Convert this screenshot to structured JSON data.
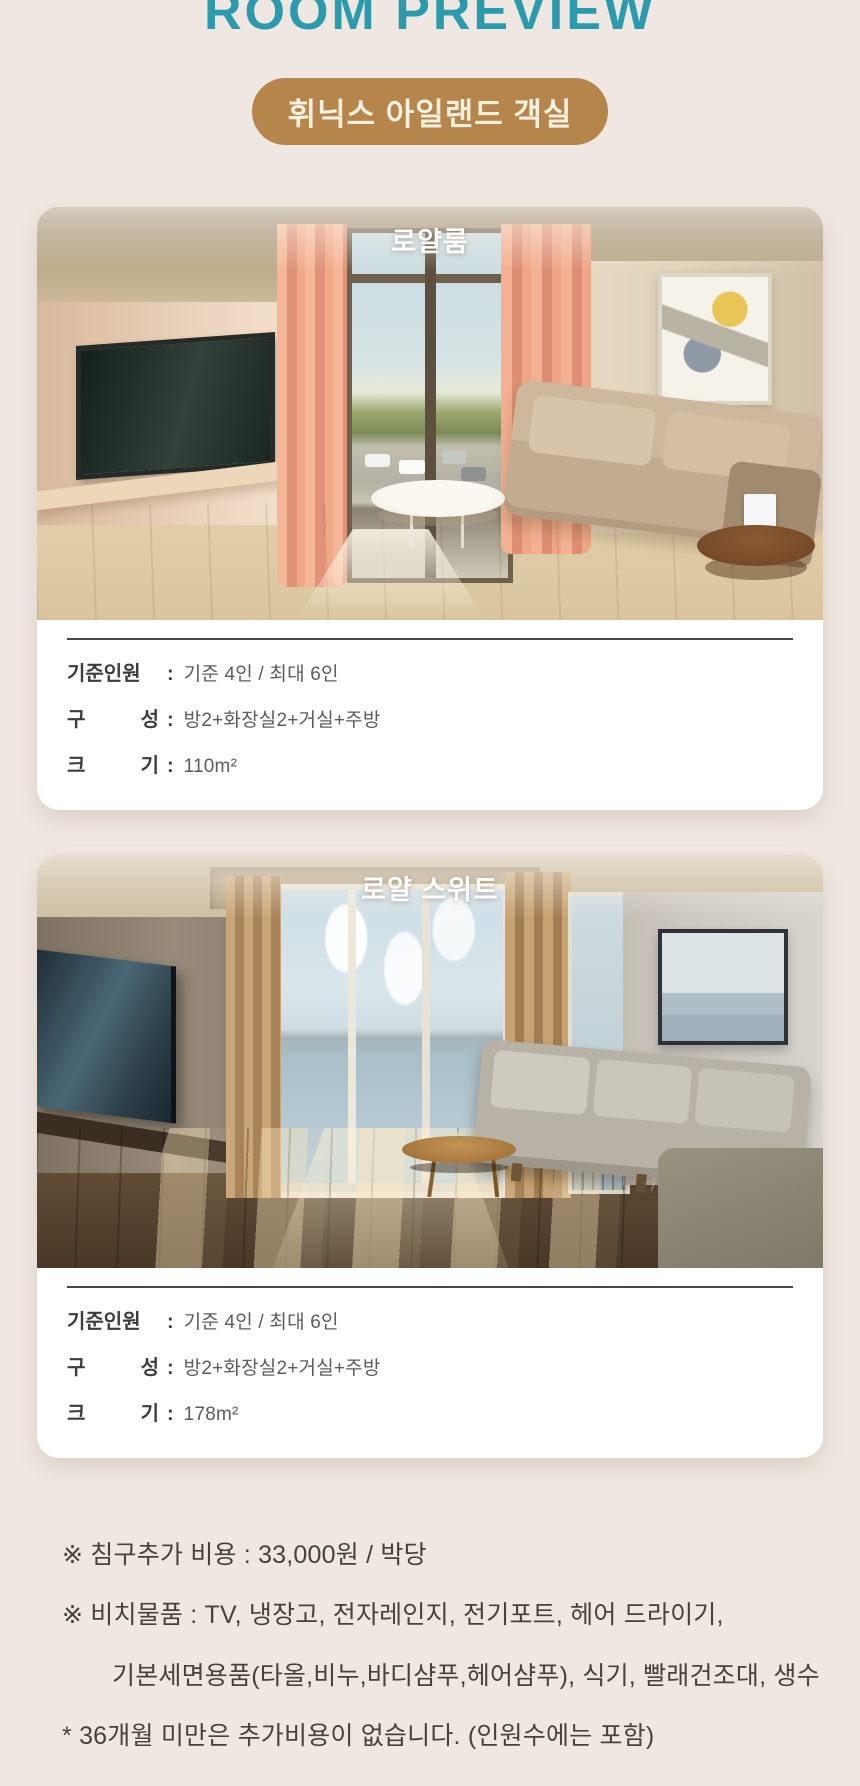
{
  "page": {
    "title": "ROOM PREVIEW",
    "badge": "휘닉스 아일랜드 객실",
    "colors": {
      "background": "#efe7e1",
      "title": "#2b9aad",
      "badge_bg": "#b5854c",
      "badge_text": "#f9f0df",
      "card_bg": "#ffffff",
      "divider": "#474747",
      "label_text": "#3c3c3c",
      "value_text": "#5c5c5c",
      "note_text": "#4a4239"
    }
  },
  "ui": {
    "colon": ":"
  },
  "cards": [
    {
      "title": "로얄룸",
      "info": [
        {
          "label": "기준인원",
          "value": "기준 4인 / 최대 6인"
        },
        {
          "label": "구 성",
          "value": "방2+화장실2+거실+주방"
        },
        {
          "label": "크 기",
          "value": "110m²"
        }
      ]
    },
    {
      "title": "로얄 스위트",
      "info": [
        {
          "label": "기준인원",
          "value": "기준 4인 / 최대 6인"
        },
        {
          "label": "구 성",
          "value": "방2+화장실2+거실+주방"
        },
        {
          "label": "크 기",
          "value": "178m²"
        }
      ]
    }
  ],
  "notes": [
    "※ 침구추가 비용 : 33,000원 / 박당",
    "※ 비치물품 : TV, 냉장고, 전자레인지, 전기포트, 헤어 드라이기,",
    "기본세면용품(타올,비누,바디샴푸,헤어샴푸), 식기, 빨래건조대, 생수",
    "* 36개월 미만은 추가비용이 없습니다. (인원수에는 포함)"
  ]
}
